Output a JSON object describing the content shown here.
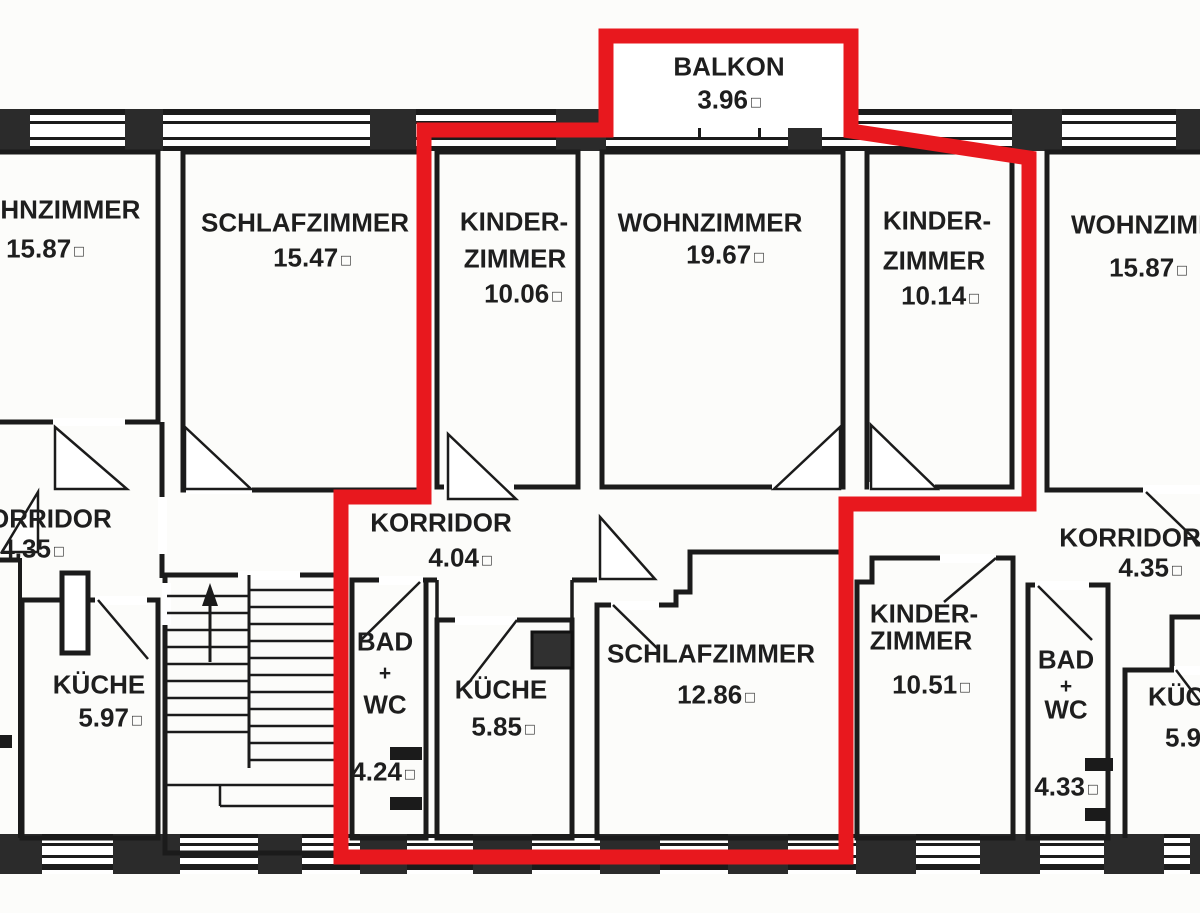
{
  "meta": {
    "type": "floor-plan",
    "language": "de"
  },
  "units": {
    "area_symbol": "□"
  },
  "highlight": {
    "color": "#e8181e",
    "meaning": "selected-apartment-outline"
  },
  "balkon": {
    "name": "BALKON",
    "area": "3.96"
  },
  "rooms": {
    "wohnzimmer_left": {
      "name": "WOHNZIMMER",
      "area": "15.87"
    },
    "schlafzimmer_top": {
      "name": "SCHLAFZIMMER",
      "area": "15.47"
    },
    "kinderzimmer_left": {
      "name_line1": "KINDER-",
      "name_line2": "ZIMMER",
      "area": "10.06"
    },
    "wohnzimmer_mid": {
      "name": "WOHNZIMMER",
      "area": "19.67"
    },
    "kinderzimmer_right": {
      "name_line1": "KINDER-",
      "name_line2": "ZIMMER",
      "area": "10.14"
    },
    "wohnzimmer_right": {
      "name": "WOHNZIMMER",
      "area": "15.87"
    },
    "korridor_left": {
      "name": "KORRIDOR",
      "area": "4.35"
    },
    "korridor_mid": {
      "name": "KORRIDOR",
      "area": "4.04"
    },
    "korridor_right": {
      "name": "KORRIDOR",
      "area": "4.35"
    },
    "kueche_left": {
      "name": "KÜCHE",
      "area": "5.97"
    },
    "bad_wc_mid": {
      "line1": "BAD",
      "line2": "+",
      "line3": "WC",
      "area": "4.24"
    },
    "kueche_mid": {
      "name": "KÜCHE",
      "area": "5.85"
    },
    "schlafzimmer_bottom": {
      "name": "SCHLAFZIMMER",
      "area": "12.86"
    },
    "kinderzimmer_bottom": {
      "name_line1": "KINDER-",
      "name_line2": "ZIMMER",
      "area": "10.51"
    },
    "bad_wc_right": {
      "line1": "BAD",
      "line2": "+",
      "line3": "WC",
      "area": "4.33"
    },
    "kueche_right": {
      "name": "KÜCHE",
      "area": "5.9"
    }
  }
}
